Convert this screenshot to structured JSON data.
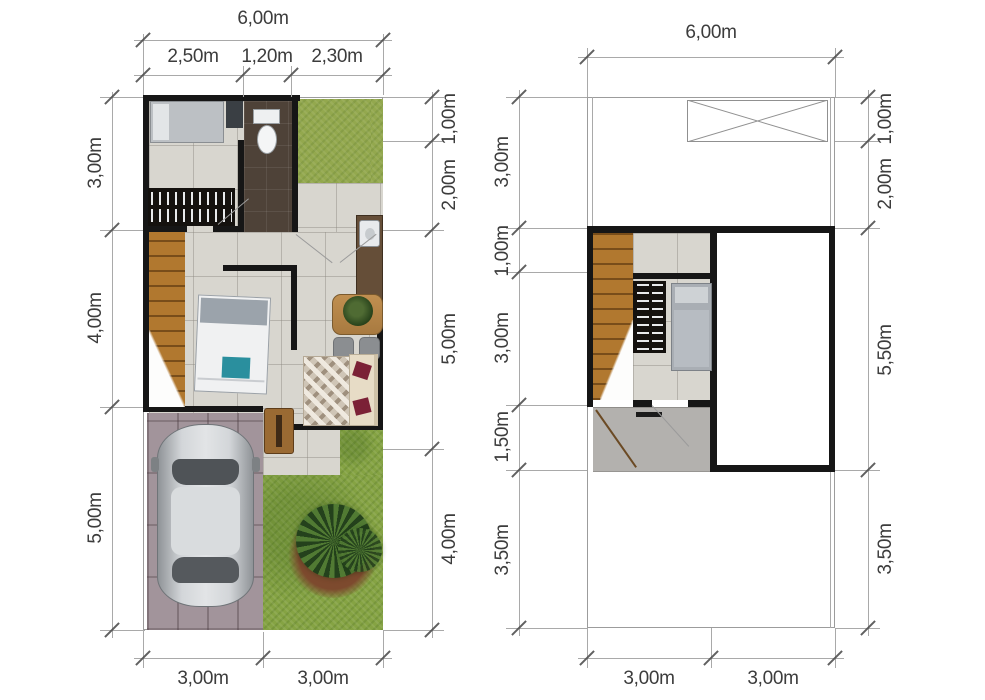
{
  "palette": {
    "wall": "#1a1a1a",
    "dimension_text": "#3c3c3c",
    "annotation_line": "#a9a9a9",
    "floor_tile": "#d8d6cf",
    "bathroom_floor": "#4e4238",
    "garden_grass": "#93a84e",
    "lawn_grass": "#85a343",
    "stair_wood": "#b1782f",
    "driveway_paver": "#a2949b",
    "balcony_gray": "#b3b1ae",
    "car_body": "#c9ccd0",
    "sofa_cream": "#e7dcc6",
    "pillow_red": "#7b2136"
  },
  "plans": [
    {
      "id": "ground-floor",
      "dims": {
        "top_overall": "6,00m",
        "top_segments": [
          "2,50m",
          "1,20m",
          "2,30m"
        ],
        "left": [
          "3,00m",
          "4,00m",
          "5,00m"
        ],
        "right": [
          "1,00m",
          "2,00m",
          "5,00m",
          "4,00m"
        ],
        "bottom": [
          "3,00m",
          "3,00m"
        ]
      }
    },
    {
      "id": "upper-floor",
      "dims": {
        "top_overall": "6,00m",
        "left": [
          "3,00m",
          "1,00m",
          "3,00m",
          "1,50m",
          "3,50m"
        ],
        "right": [
          "1,00m",
          "2,00m",
          "5,50m",
          "3,50m"
        ],
        "bottom": [
          "3,00m",
          "3,00m"
        ]
      }
    }
  ]
}
